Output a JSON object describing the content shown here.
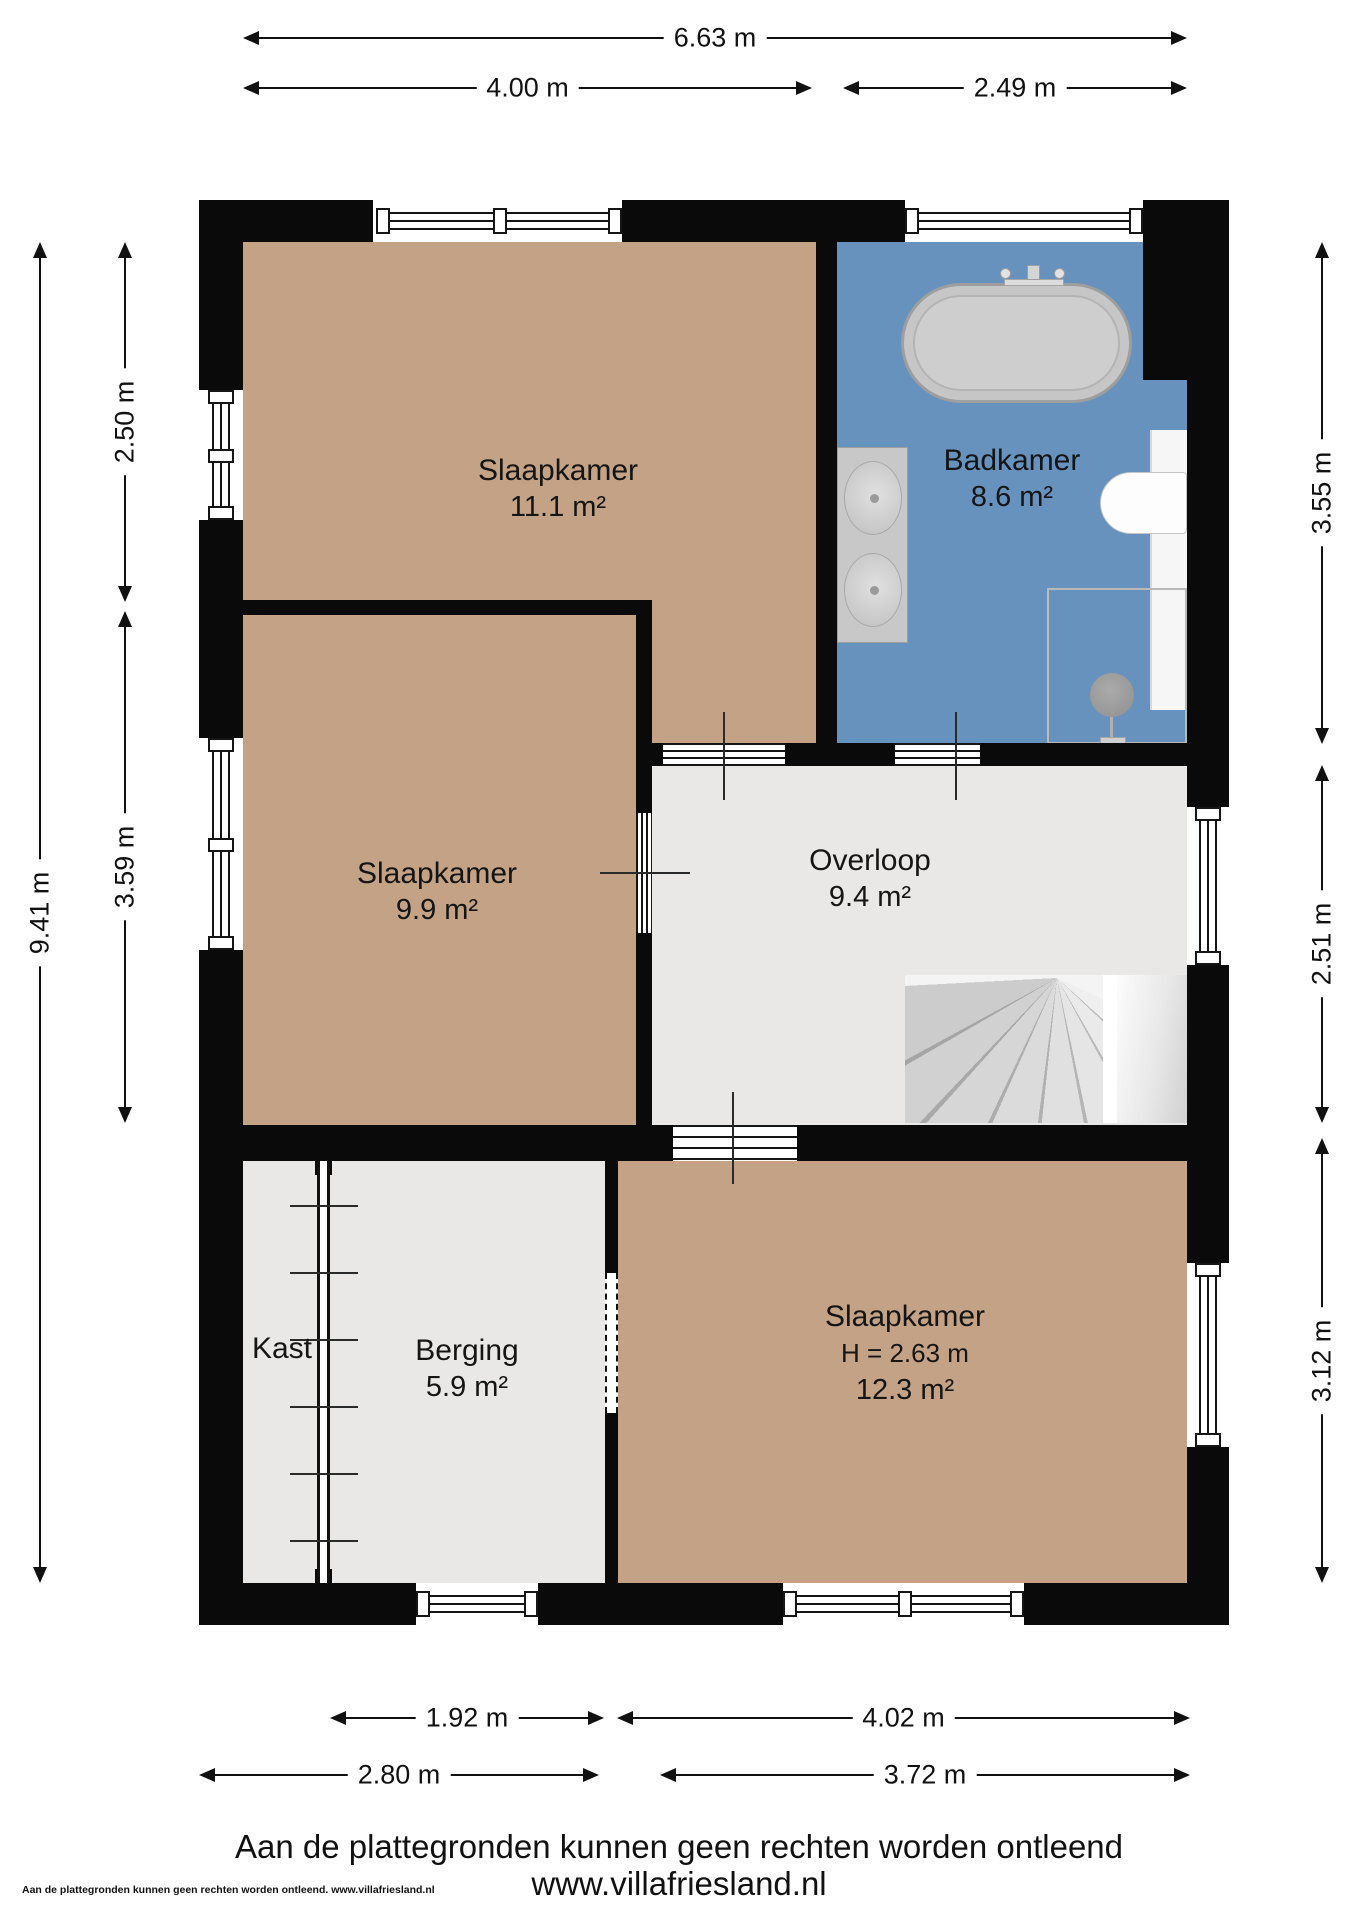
{
  "rooms": {
    "slaapkamer_top": {
      "name": "Slaapkamer",
      "area": "11.1 m²"
    },
    "badkamer": {
      "name": "Badkamer",
      "area": "8.6 m²"
    },
    "slaapkamer_mid": {
      "name": "Slaapkamer",
      "area": "9.9 m²"
    },
    "overloop": {
      "name": "Overloop",
      "area": "9.4 m²"
    },
    "kast": {
      "name": "Kast"
    },
    "berging": {
      "name": "Berging",
      "area": "5.9 m²"
    },
    "slaapkamer_bottom": {
      "name": "Slaapkamer",
      "height": "H = 2.63 m",
      "area": "12.3 m²"
    }
  },
  "dimensions": {
    "top_total": "6.63 m",
    "top_left": "4.00 m",
    "top_right": "2.49 m",
    "left_total": "9.41 m",
    "left_upper": "2.50 m",
    "left_middle": "3.59 m",
    "right_upper": "3.55 m",
    "right_middle": "2.51 m",
    "right_lower": "3.12 m",
    "bottom_inner_left": "1.92 m",
    "bottom_inner_right": "4.02 m",
    "bottom_outer_left": "2.80 m",
    "bottom_outer_right": "3.72 m"
  },
  "footer": {
    "line1": "Aan de plattegronden kunnen geen rechten worden ontleend",
    "line2": "www.villafriesland.nl",
    "fineprint": "Aan de plattegronden kunnen geen rechten worden ontleend. www.villafriesland.nl"
  },
  "colors": {
    "wall": "#0a0a0a",
    "floor_tan": "#c3a286",
    "floor_blue": "#6892be",
    "floor_gray": "#e9e8e6"
  }
}
